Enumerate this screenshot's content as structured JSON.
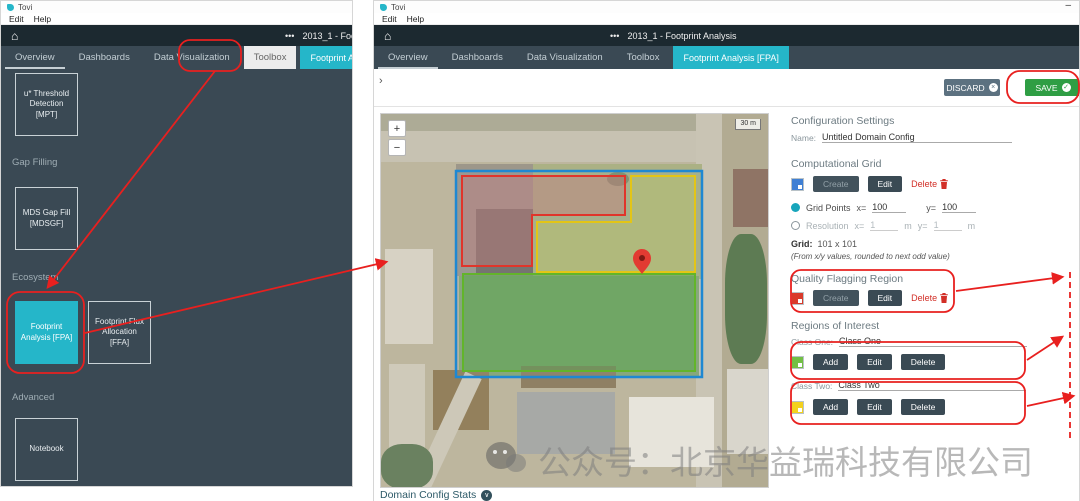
{
  "icons": {
    "home": "⌂",
    "dots": "•••",
    "minimize": "–",
    "collapse": "›",
    "zoom_in": "+",
    "zoom_out": "−",
    "close_x": "×",
    "check": "✓",
    "chevron_down": "∨"
  },
  "colors": {
    "accent_cyan": "#25b6c9",
    "save_green": "#2f9e44",
    "discard_slate": "#5c7180",
    "annotation_red": "#e8201f",
    "delete_red": "#d22f27",
    "grid_blue": "#3f7fd4",
    "quality_red": "#d93a2b",
    "class_one_green": "#72bf44",
    "class_two_yellow": "#f3d11e"
  },
  "left_window": {
    "title": "Tovi",
    "menu": {
      "edit": "Edit",
      "help": "Help"
    },
    "header": {
      "title": "2013_1 - Footprint Analysis"
    },
    "tabs": [
      {
        "label": "Overview"
      },
      {
        "label": "Dashboards"
      },
      {
        "label": "Data Visualization"
      },
      {
        "label": "Toolbox"
      },
      {
        "label": "Footprint Analysis [FPA]"
      }
    ],
    "sections": {
      "gap_filling": "Gap Filling",
      "ecosystem": "Ecosystem",
      "advanced": "Advanced"
    },
    "tiles": {
      "mpt": "u* Threshold Detection [MPT]",
      "mdsgf": "MDS Gap Fill [MDSGF]",
      "fpa": "Footprint Analysis [FPA]",
      "ffa": "Footprint Flux Allocation [FFA]",
      "notebook": "Notebook"
    }
  },
  "right_window": {
    "title": "Tovi",
    "menu": {
      "edit": "Edit",
      "help": "Help"
    },
    "header": {
      "title": "2013_1 - Footprint Analysis"
    },
    "tabs": [
      {
        "label": "Overview"
      },
      {
        "label": "Dashboards"
      },
      {
        "label": "Data Visualization"
      },
      {
        "label": "Toolbox"
      },
      {
        "label": "Footprint Analysis [FPA]"
      }
    ],
    "toolbar": {
      "discard_label": "DISCARD",
      "save_label": "SAVE"
    },
    "map": {
      "scale_label": "30 m"
    },
    "stats": {
      "label": "Domain Config Stats"
    },
    "config": {
      "title": "Configuration Settings",
      "name_label": "Name:",
      "name_value": "Untitled Domain Config",
      "computational_grid": {
        "title": "Computational Grid",
        "create_label": "Create",
        "edit_label": "Edit",
        "delete_label": "Delete",
        "grid_points_label": "Grid Points",
        "x_label": "x=",
        "x_value": "100",
        "y_label": "y=",
        "y_value": "100",
        "resolution_label": "Resolution",
        "res_x_value": "1",
        "res_y_value": "1",
        "meters_label": "m",
        "grid_label": "Grid:",
        "grid_value": "101 x 101",
        "note": "(From x/y values, rounded to next odd value)"
      },
      "quality_flagging": {
        "title": "Quality Flagging Region",
        "create_label": "Create",
        "edit_label": "Edit",
        "delete_label": "Delete"
      },
      "regions_of_interest": {
        "title": "Regions of Interest",
        "class_one_label": "Class One:",
        "class_one_value": "Class One",
        "class_two_label": "Class Two:",
        "class_two_value": "Class Two",
        "add_label": "Add",
        "edit_label": "Edit",
        "delete_label": "Delete"
      }
    }
  },
  "watermark": {
    "text": "公众号：北京华益瑞科技有限公司"
  }
}
